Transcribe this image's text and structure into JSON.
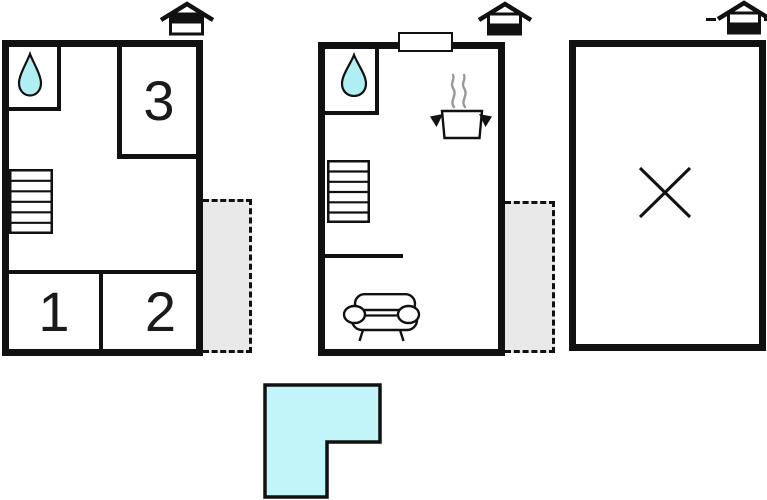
{
  "image": {
    "type": "holiday-home-floor-plan",
    "background": "#ffffff"
  },
  "colors": {
    "wall": "#111111",
    "water_drop": "#b0eef3",
    "terrace": "#e9e9e9",
    "ground_plan": "#c2f5f9",
    "steam": "#999999",
    "window_fill": "#ffffff",
    "label_text": "#1a1a1a"
  },
  "units": {
    "left": {
      "room_labels": {
        "room1": "1",
        "room2": "2",
        "room3": "3"
      },
      "features": [
        "bathroom-water-drop",
        "stairs",
        "dashed-terrace",
        "house-orientation-black-top"
      ]
    },
    "middle": {
      "features": [
        "bathroom-water-drop",
        "stairs",
        "cooking-pot-with-steam",
        "sofa",
        "window-opening",
        "dashed-terrace",
        "house-orientation-black-bottom"
      ]
    },
    "right": {
      "features": [
        "empty-room-x-marker",
        "house-orientation-black-bottom-with-dashes"
      ]
    }
  },
  "ground_plan": {
    "shape": "L-shaped-footprint"
  }
}
